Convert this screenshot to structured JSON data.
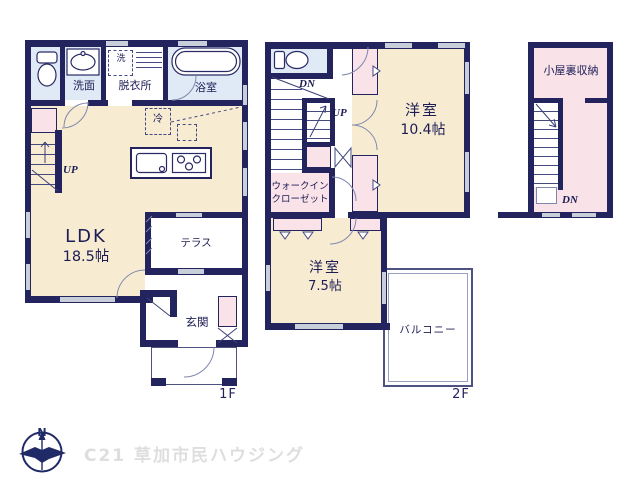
{
  "colors": {
    "wall": "#23235e",
    "room_beige": "#f7ecd2",
    "closet_pink": "#f9e3e9",
    "sanitary_blue": "#dfeaf6",
    "window_gray": "#c9cedb",
    "label_navy": "#1d1d55",
    "logo_gray": "#dedede"
  },
  "floor1": {
    "floor_label": "1F",
    "ldk": "LDK",
    "ldk_size": "18.5帖",
    "washroom": "洗面",
    "dressing": "脱衣所",
    "bath": "浴室",
    "washer": "洗",
    "fridge": "冷",
    "terrace": "テラス",
    "entrance": "玄関",
    "stairs_up": "UP"
  },
  "floor2": {
    "floor_label": "2F",
    "room_main": "洋室",
    "room_main_size": "10.4帖",
    "room_sub": "洋室",
    "room_sub_size": "7.5帖",
    "wic_line1": "ウォークイン",
    "wic_line2": "クローゼット",
    "balcony": "バルコニー",
    "stairs_down": "DN",
    "stairs_up": "UP"
  },
  "attic": {
    "room": "小屋裏収納",
    "stairs_down": "DN"
  },
  "footer": {
    "north": "N",
    "company": "C21 草加市民ハウジング"
  }
}
